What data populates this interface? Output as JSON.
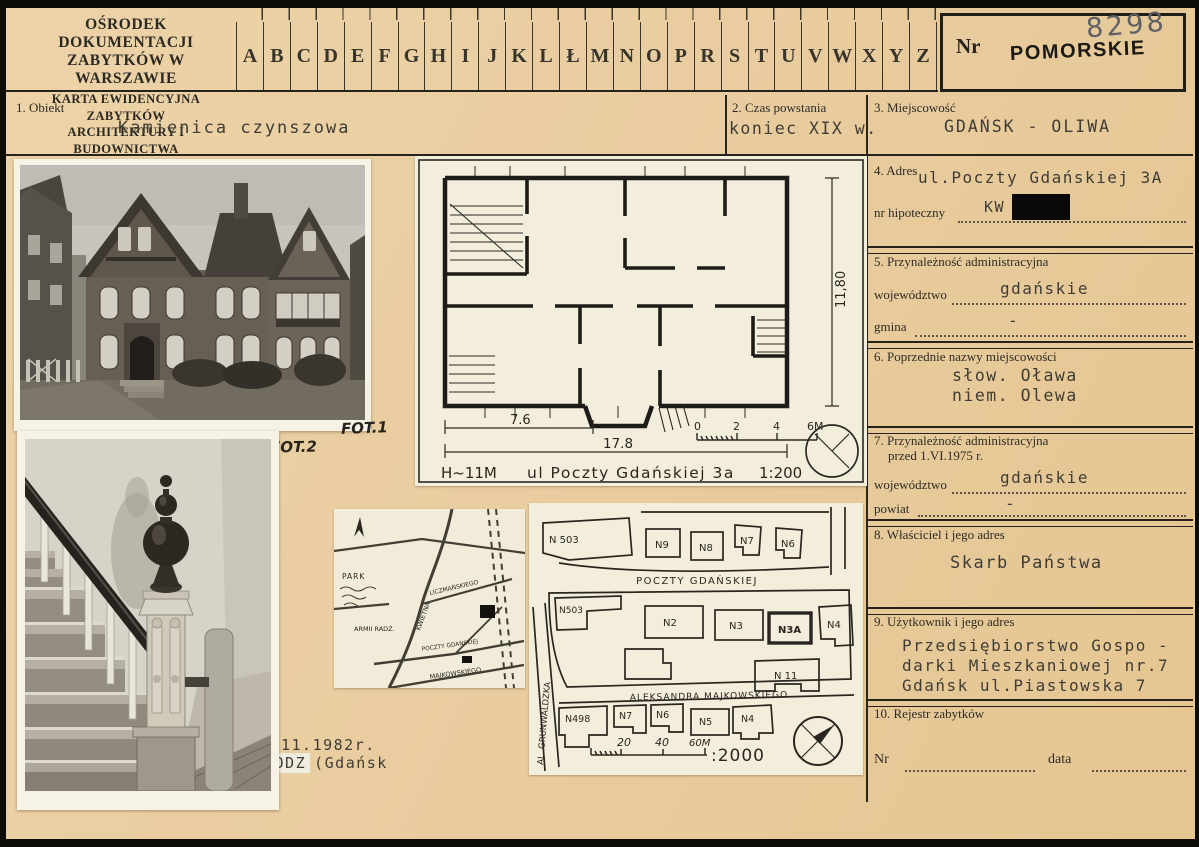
{
  "header": {
    "institution_line1": "OŚRODEK DOKUMENTACJI",
    "institution_line2": "ZABYTKÓW W WARSZAWIE",
    "card_type_line1": "KARTA EWIDENCYJNA ZABYTKÓW",
    "card_type_line2": "ARCHITEKTURY I BUDOWNICTWA",
    "alphabet": [
      "A",
      "B",
      "C",
      "D",
      "E",
      "F",
      "G",
      "H",
      "I",
      "J",
      "K",
      "L",
      "Ł",
      "M",
      "N",
      "O",
      "P",
      "R",
      "S",
      "T",
      "U",
      "V",
      "W",
      "X",
      "Y",
      "Z"
    ],
    "nr_label": "Nr",
    "region_stamp": "POMORSKIE",
    "handwritten_number": "8298"
  },
  "fields": {
    "obiekt": {
      "label": "1. Obiekt",
      "value": "Kamienica czynszowa"
    },
    "czas": {
      "label": "2. Czas powstania",
      "value": "koniec XIX w."
    },
    "miejscowosc": {
      "label": "3. Miejscowość",
      "value": "GDAŃSK - OLIWA"
    },
    "adres": {
      "label": "4. Adres",
      "value": "ul.Poczty Gdańskiej 3A",
      "hipoteczny_label": "nr hipoteczny",
      "hipoteczny_value": "KW"
    },
    "przynaleznosc": {
      "label": "5. Przynależność administracyjna",
      "wojewodztwo_label": "województwo",
      "wojewodztwo_value": "gdańskie",
      "gmina_label": "gmina",
      "gmina_value": "-"
    },
    "poprzednie": {
      "label": "6. Poprzednie nazwy miejscowości",
      "line1": "słow. Oława",
      "line2": "niem. Olewa"
    },
    "przynaleznosc_1975": {
      "label": "7. Przynależność administracyjna",
      "label2": "przed 1.VI.1975 r.",
      "wojewodztwo_label": "województwo",
      "wojewodztwo_value": "gdańskie",
      "powiat_label": "powiat",
      "powiat_value": "-"
    },
    "wlasciciel": {
      "label": "8. Właściciel i jego adres",
      "value": "Skarb Państwa"
    },
    "uzytkownik": {
      "label": "9. Użytkownik i jego adres",
      "line1": "Przedsiębiorstwo Gospo -",
      "line2": "darki Mieszkaniowej nr.7",
      "line3": "Gdańsk ul.Piastowska 7"
    },
    "rejestr": {
      "label": "10. Rejestr zabytków",
      "nr_label": "Nr",
      "data_label": "data"
    }
  },
  "photos": {
    "fot1": "FOT.1",
    "fot2": "FOT.2"
  },
  "floorplan": {
    "dim_partial": "7.6",
    "dim_total": "17.8",
    "dim_side": "11,80",
    "height_note": "H~11M",
    "caption": "ul Poczty Gdańskiej 3a",
    "scale": "1:200",
    "scalebar": [
      "0",
      "2",
      "4",
      "6M"
    ]
  },
  "siteplan": {
    "street_top": "POCZTY GDAŃSKIEJ",
    "street_bottom": "ALEKSANDRA MAJKOWSKIEGO",
    "street_left": "AL. GRUNWALDZKA",
    "buildings_top": [
      "N 503",
      "N9",
      "N8",
      "N7",
      "N6"
    ],
    "buildings_middle": [
      "N503",
      "N2",
      "N3",
      "N3A",
      "N4",
      "N 11"
    ],
    "buildings_bottom": [
      "N498",
      "N7",
      "N6",
      "N5",
      "N4"
    ],
    "scale_ticks": [
      "20",
      "40",
      "60M"
    ],
    "scale_note": ":2000"
  },
  "minimap": {
    "labels": {
      "park": "PARK",
      "street1": "ARMII RADZ.",
      "street2": "KWIETNA",
      "street3": "LICZMAŃSKIEGO",
      "street4": "POCZTY GDAŃSKIEJ",
      "street5": "MAJKOWSKIEGO"
    }
  },
  "annotations": {
    "date_line": "11.1982r.",
    "stamp": "GODZ",
    "stamp_suffix": "(Gdańsk"
  },
  "colors": {
    "card_bg": "#e9cda0",
    "paper": "#f3eedc",
    "ink": "#2d2a24",
    "typed": "#3f3c35",
    "stamp": "#1c1a16",
    "pencil": "#5d6166",
    "redaction": "#0b0a09"
  }
}
